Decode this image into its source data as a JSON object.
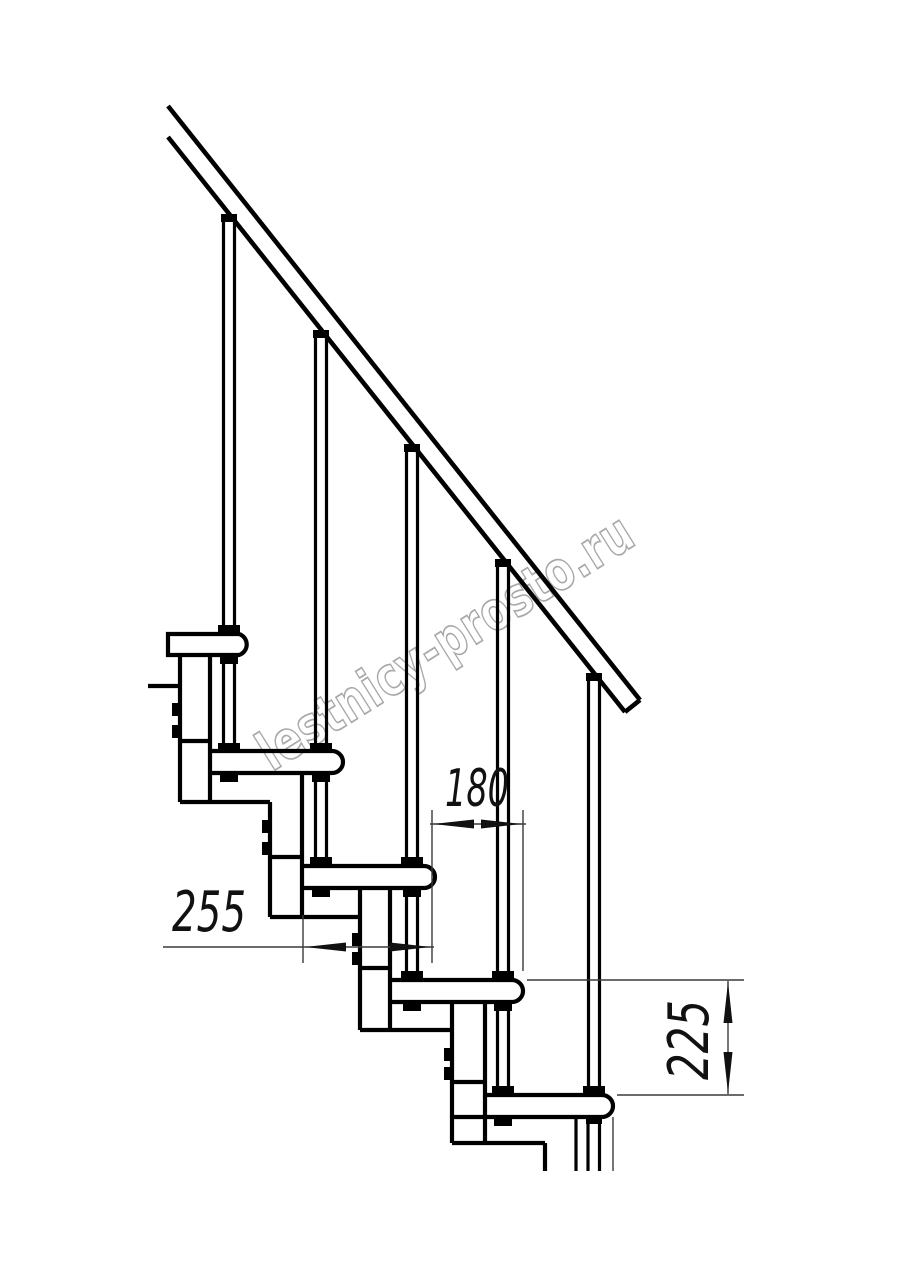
{
  "page": {
    "background_color": "#ffffff"
  },
  "drawing": {
    "line_color": "#000000",
    "dimension_line_color": "#3a3a3a",
    "text_color": "#111111",
    "dimensions": {
      "step_run": {
        "value": "180",
        "orientation": "horizontal"
      },
      "tread_depth": {
        "value": "255",
        "orientation": "horizontal"
      },
      "step_rise": {
        "value": "225",
        "orientation": "vertical"
      }
    },
    "watermark": {
      "text": "lestnicy-prosto.ru",
      "color": "#9a9a9a"
    }
  }
}
